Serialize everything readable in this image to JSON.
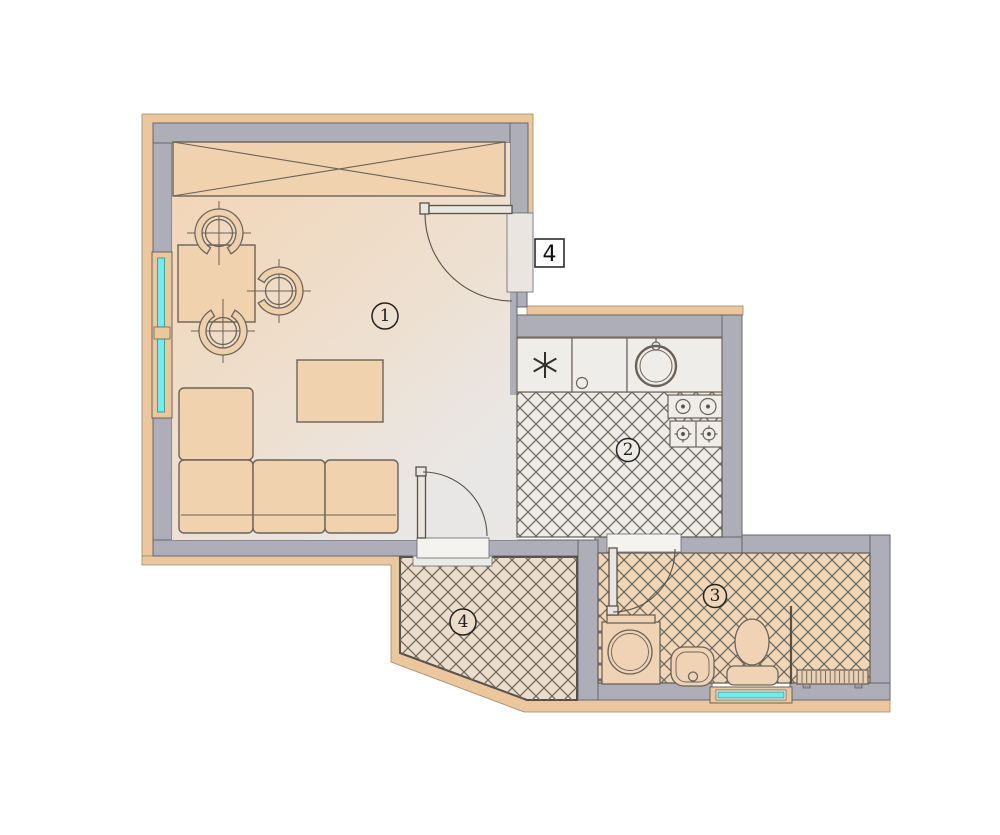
{
  "plan": {
    "apartment_number": "4",
    "rooms": [
      {
        "id": "living-room",
        "label": "1"
      },
      {
        "id": "kitchen",
        "label": "2"
      },
      {
        "id": "bathroom",
        "label": "3"
      },
      {
        "id": "hallway",
        "label": "4"
      }
    ]
  },
  "colors": {
    "wall": "#aeaeb8",
    "trim": "#ecc79e",
    "window_glass": "#74ecea",
    "hatch_line": "#6e685c",
    "floor_kitchen": "#edebe7",
    "floor_bath": "#f1d5b8",
    "floor_hall": "#ebdccc",
    "floor_living_a": "#f3d4b4",
    "floor_living_b": "#eedfce",
    "floor_living_c": "#e9e7e6",
    "furniture": "#f0d2ae",
    "fixture": "#efede9",
    "bath_fixture": "#f0d3b5"
  }
}
